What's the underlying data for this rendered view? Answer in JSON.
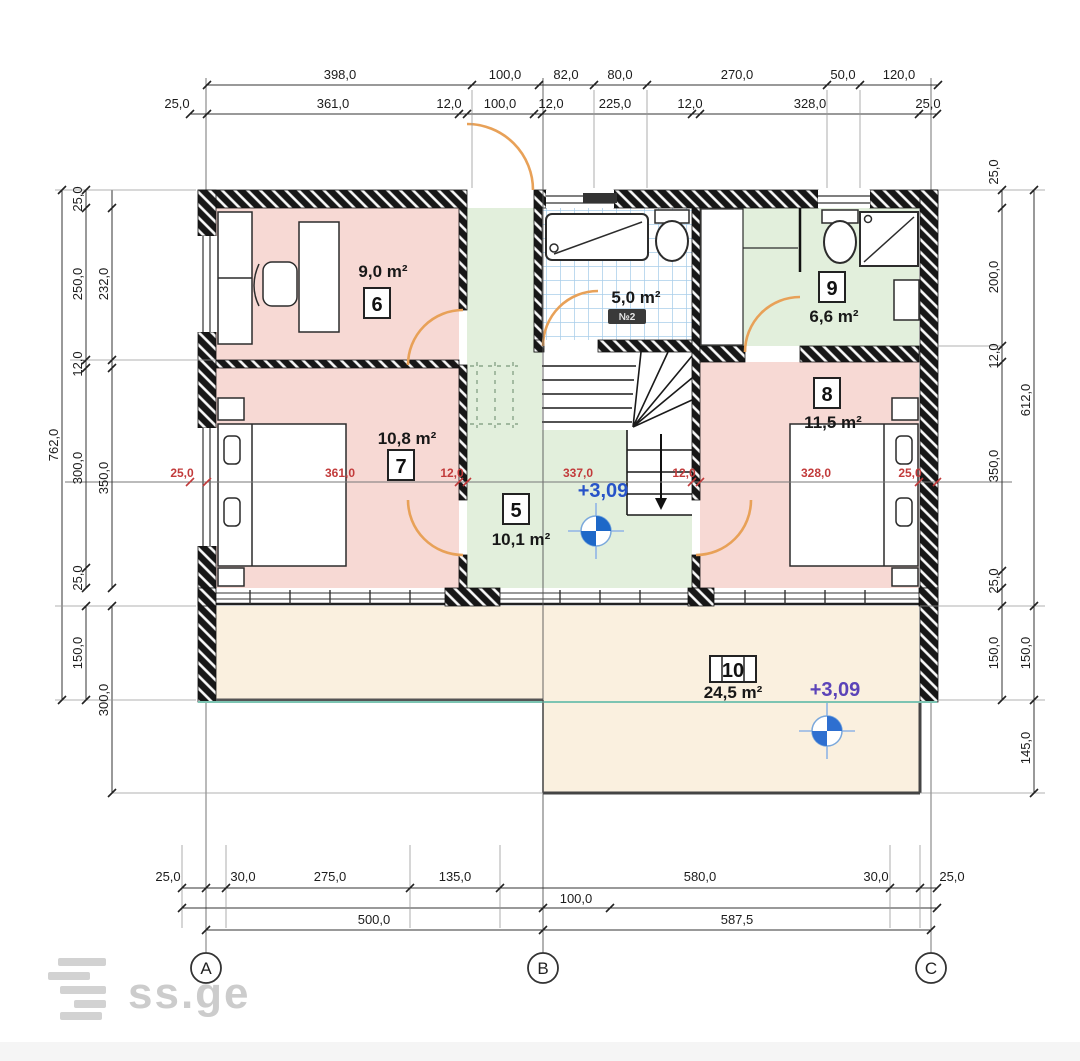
{
  "drawing_title": "second-floor plan",
  "dimensions": {
    "top_row1": [
      "398,0",
      "100,0",
      "82,0",
      "80,0",
      "270,0",
      "50,0",
      "120,0"
    ],
    "top_row2": [
      "25,0",
      "361,0",
      "12,0",
      "100,0",
      "12,0",
      "225,0",
      "12,0",
      "328,0",
      "25,0"
    ],
    "left_total": "762,0",
    "left_mid": [
      "25,0",
      "250,0",
      "12,0",
      "300,0",
      "25,0"
    ],
    "left_inner": [
      "232,0",
      "350,0"
    ],
    "left_lower": [
      "150,0",
      "300,0"
    ],
    "right_inner": [
      "25,0",
      "200,0",
      "12,0",
      "350,0",
      "25,0",
      "150,0"
    ],
    "right_outer": [
      "612,0",
      "150,0",
      "145,0"
    ],
    "bottom_row1": [
      "25,0",
      "30,0",
      "275,0",
      "135,0",
      "580,0",
      "30,0",
      "25,0"
    ],
    "bottom_row2": "100,0",
    "bottom_row3": [
      "500,0",
      "587,5"
    ],
    "interior_red": [
      "25,0",
      "361,0",
      "12,0",
      "337,0",
      "12,0",
      "328,0",
      "25,0"
    ]
  },
  "rooms": {
    "r5": {
      "number": "5",
      "area": "10,1 m²"
    },
    "r6": {
      "number": "6",
      "area": "9,0 m²"
    },
    "r7": {
      "number": "7",
      "area": "10,8 m²"
    },
    "r8": {
      "number": "8",
      "area": "11,5 m²"
    },
    "r9": {
      "number": "9",
      "area": "6,6 m²"
    },
    "r10": {
      "number": "10",
      "area": "24,5 m²"
    },
    "bathroom": {
      "area": "5,0 m²",
      "badge": "№2"
    }
  },
  "elevations": {
    "stair": "+3,09",
    "terrace": "+3,09"
  },
  "axes": {
    "a": "A",
    "b": "B",
    "c": "C"
  },
  "watermark": "ss.ge",
  "colors": {
    "room_pink": "#f7d9d4",
    "room_green": "#e2efdc",
    "terrace_cream": "#faf0df",
    "tile_blue": "#a9cdea",
    "door_orange": "#e8a158",
    "level_blue": "#1e68c8",
    "teal_line": "#7cc4b2",
    "dim_red": "#c23b3b"
  }
}
